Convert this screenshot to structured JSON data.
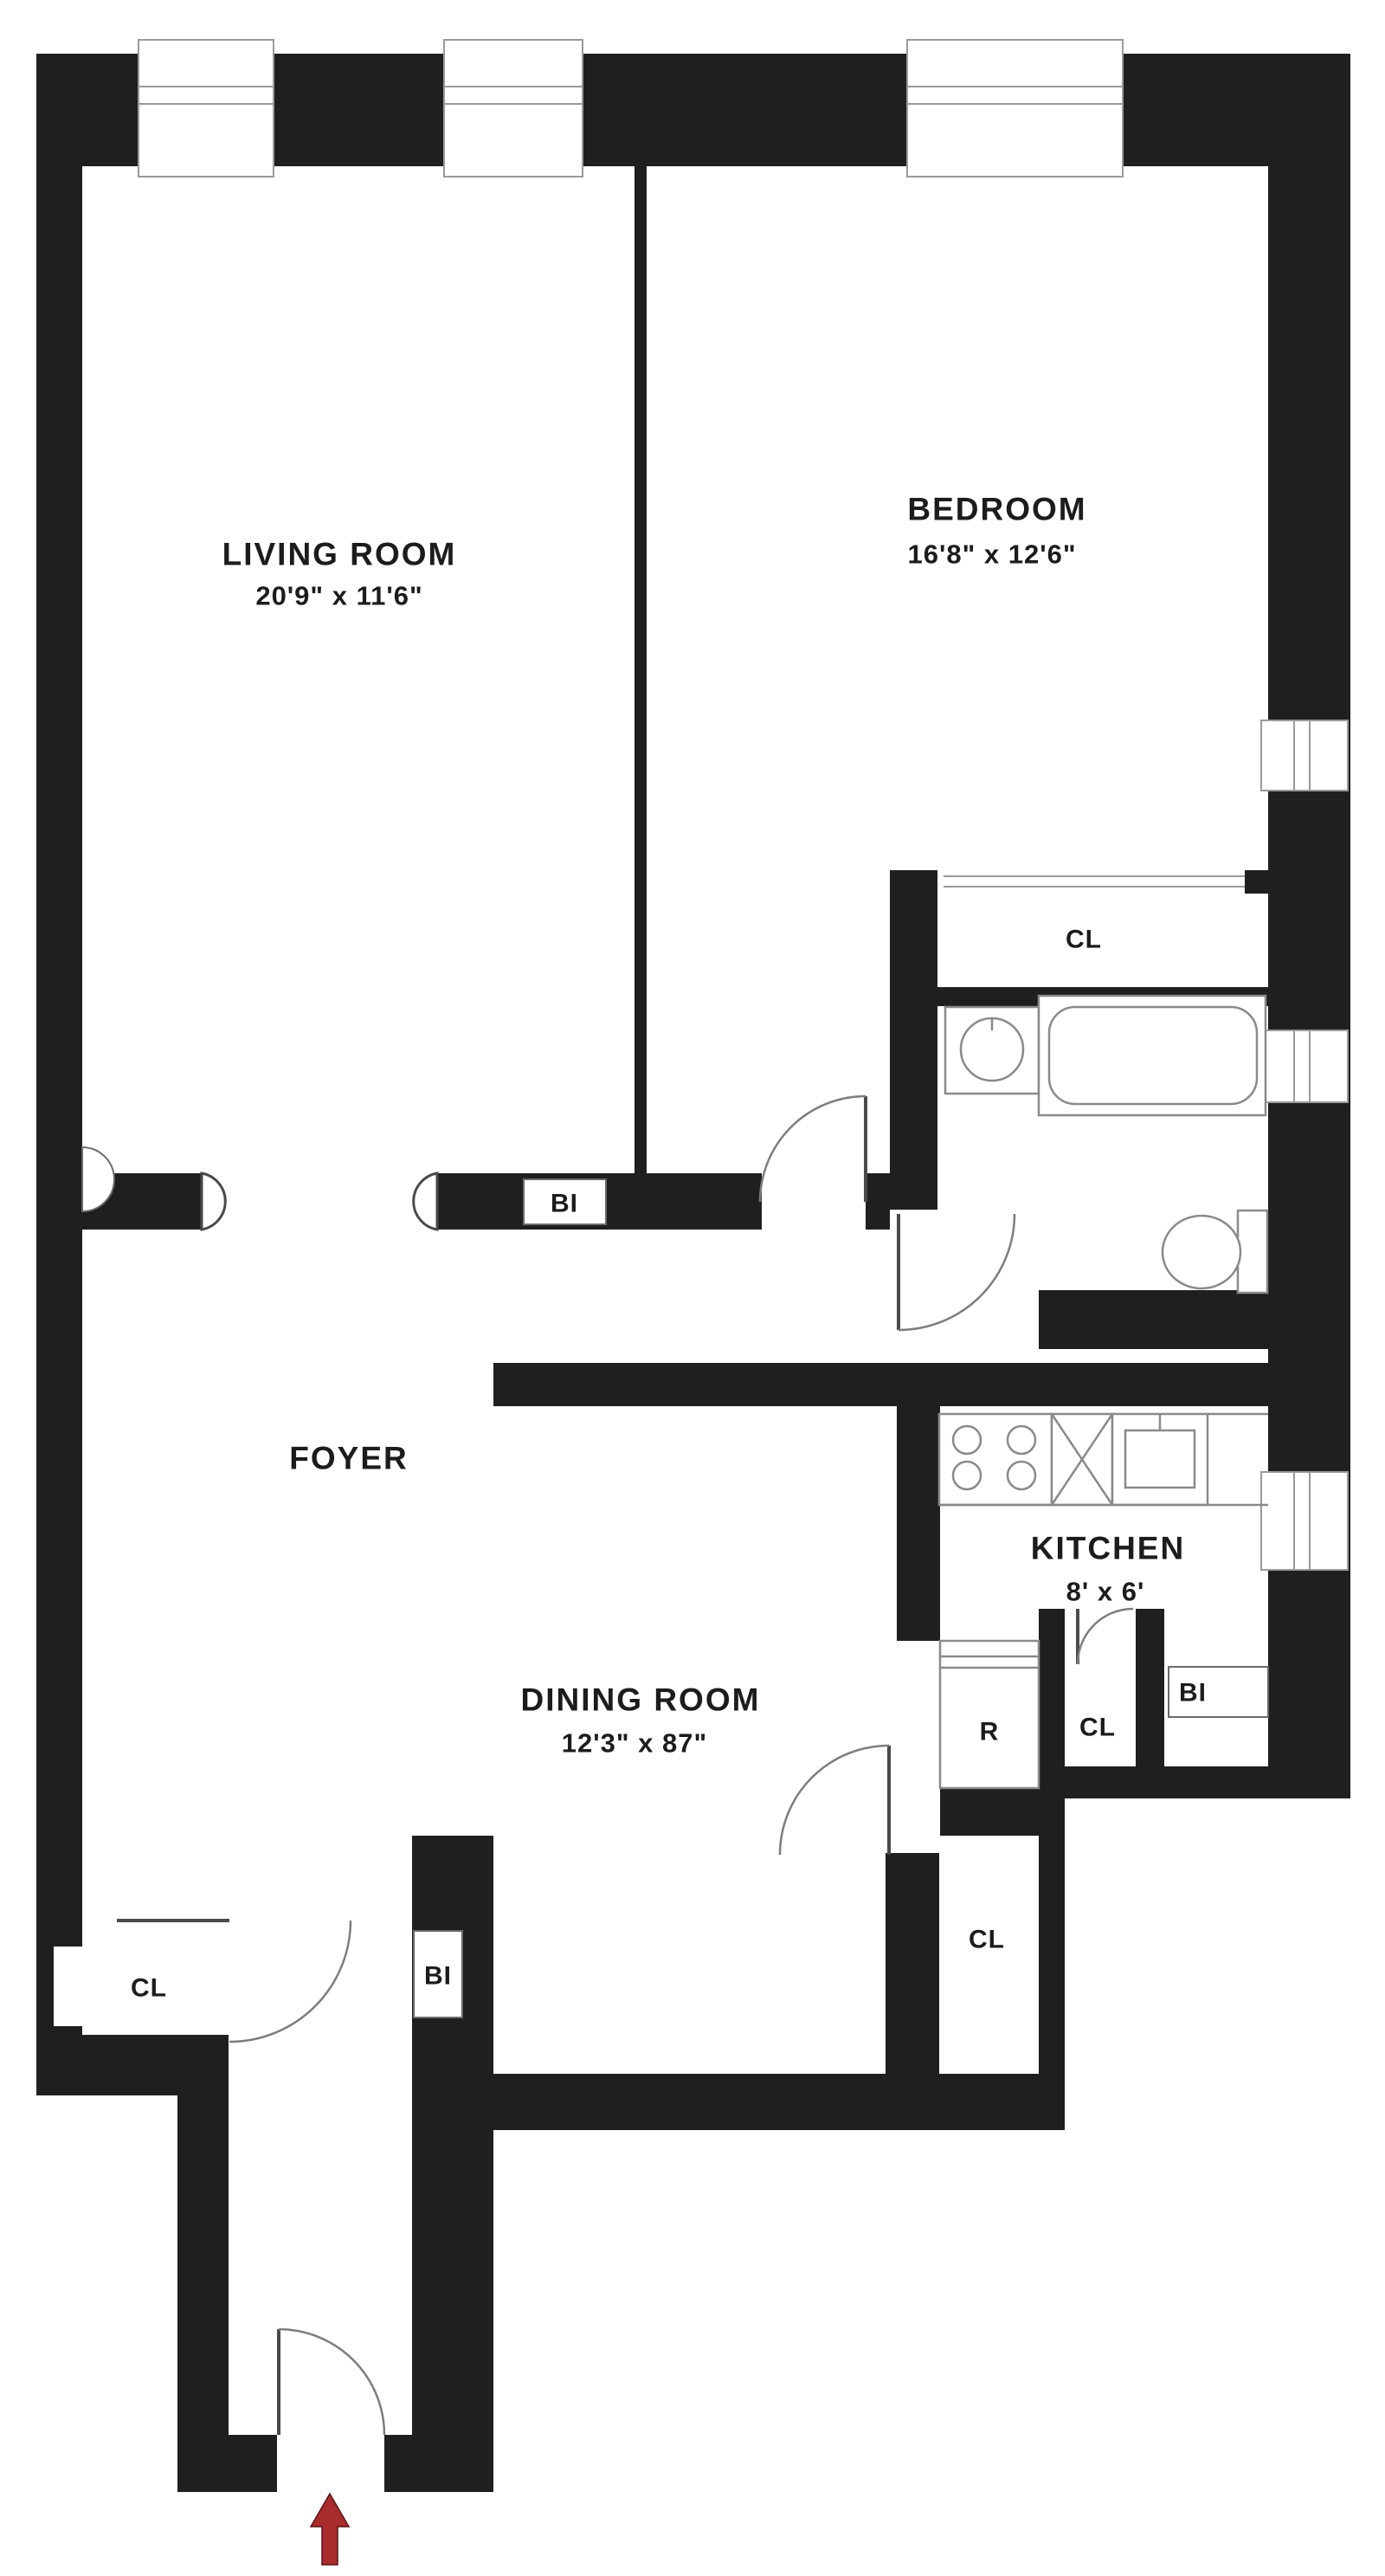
{
  "plan": {
    "type": "apartment-floor-plan",
    "rooms": {
      "living_room": {
        "name": "LIVING ROOM",
        "dims": "20'9\" x 11'6\""
      },
      "bedroom": {
        "name": "BEDROOM",
        "dims": "16'8\" x 12'6\""
      },
      "dining_room": {
        "name": "DINING ROOM",
        "dims": "12'3\" x 87\""
      },
      "kitchen": {
        "name": "KITCHEN",
        "dims": "8' x 6'"
      },
      "foyer": {
        "name": "FOYER"
      }
    },
    "labels": {
      "closet": "CL",
      "built_in": "BI",
      "refrigerator": "R"
    },
    "icons": {
      "entry_arrow": "red-up-arrow-entrance"
    },
    "colors": {
      "background": "#ffffff",
      "wall": "#211f1d",
      "fixture_line": "#8a8a8a",
      "text": "#1c1c1c",
      "arrow_red": "#a82c2c"
    }
  }
}
